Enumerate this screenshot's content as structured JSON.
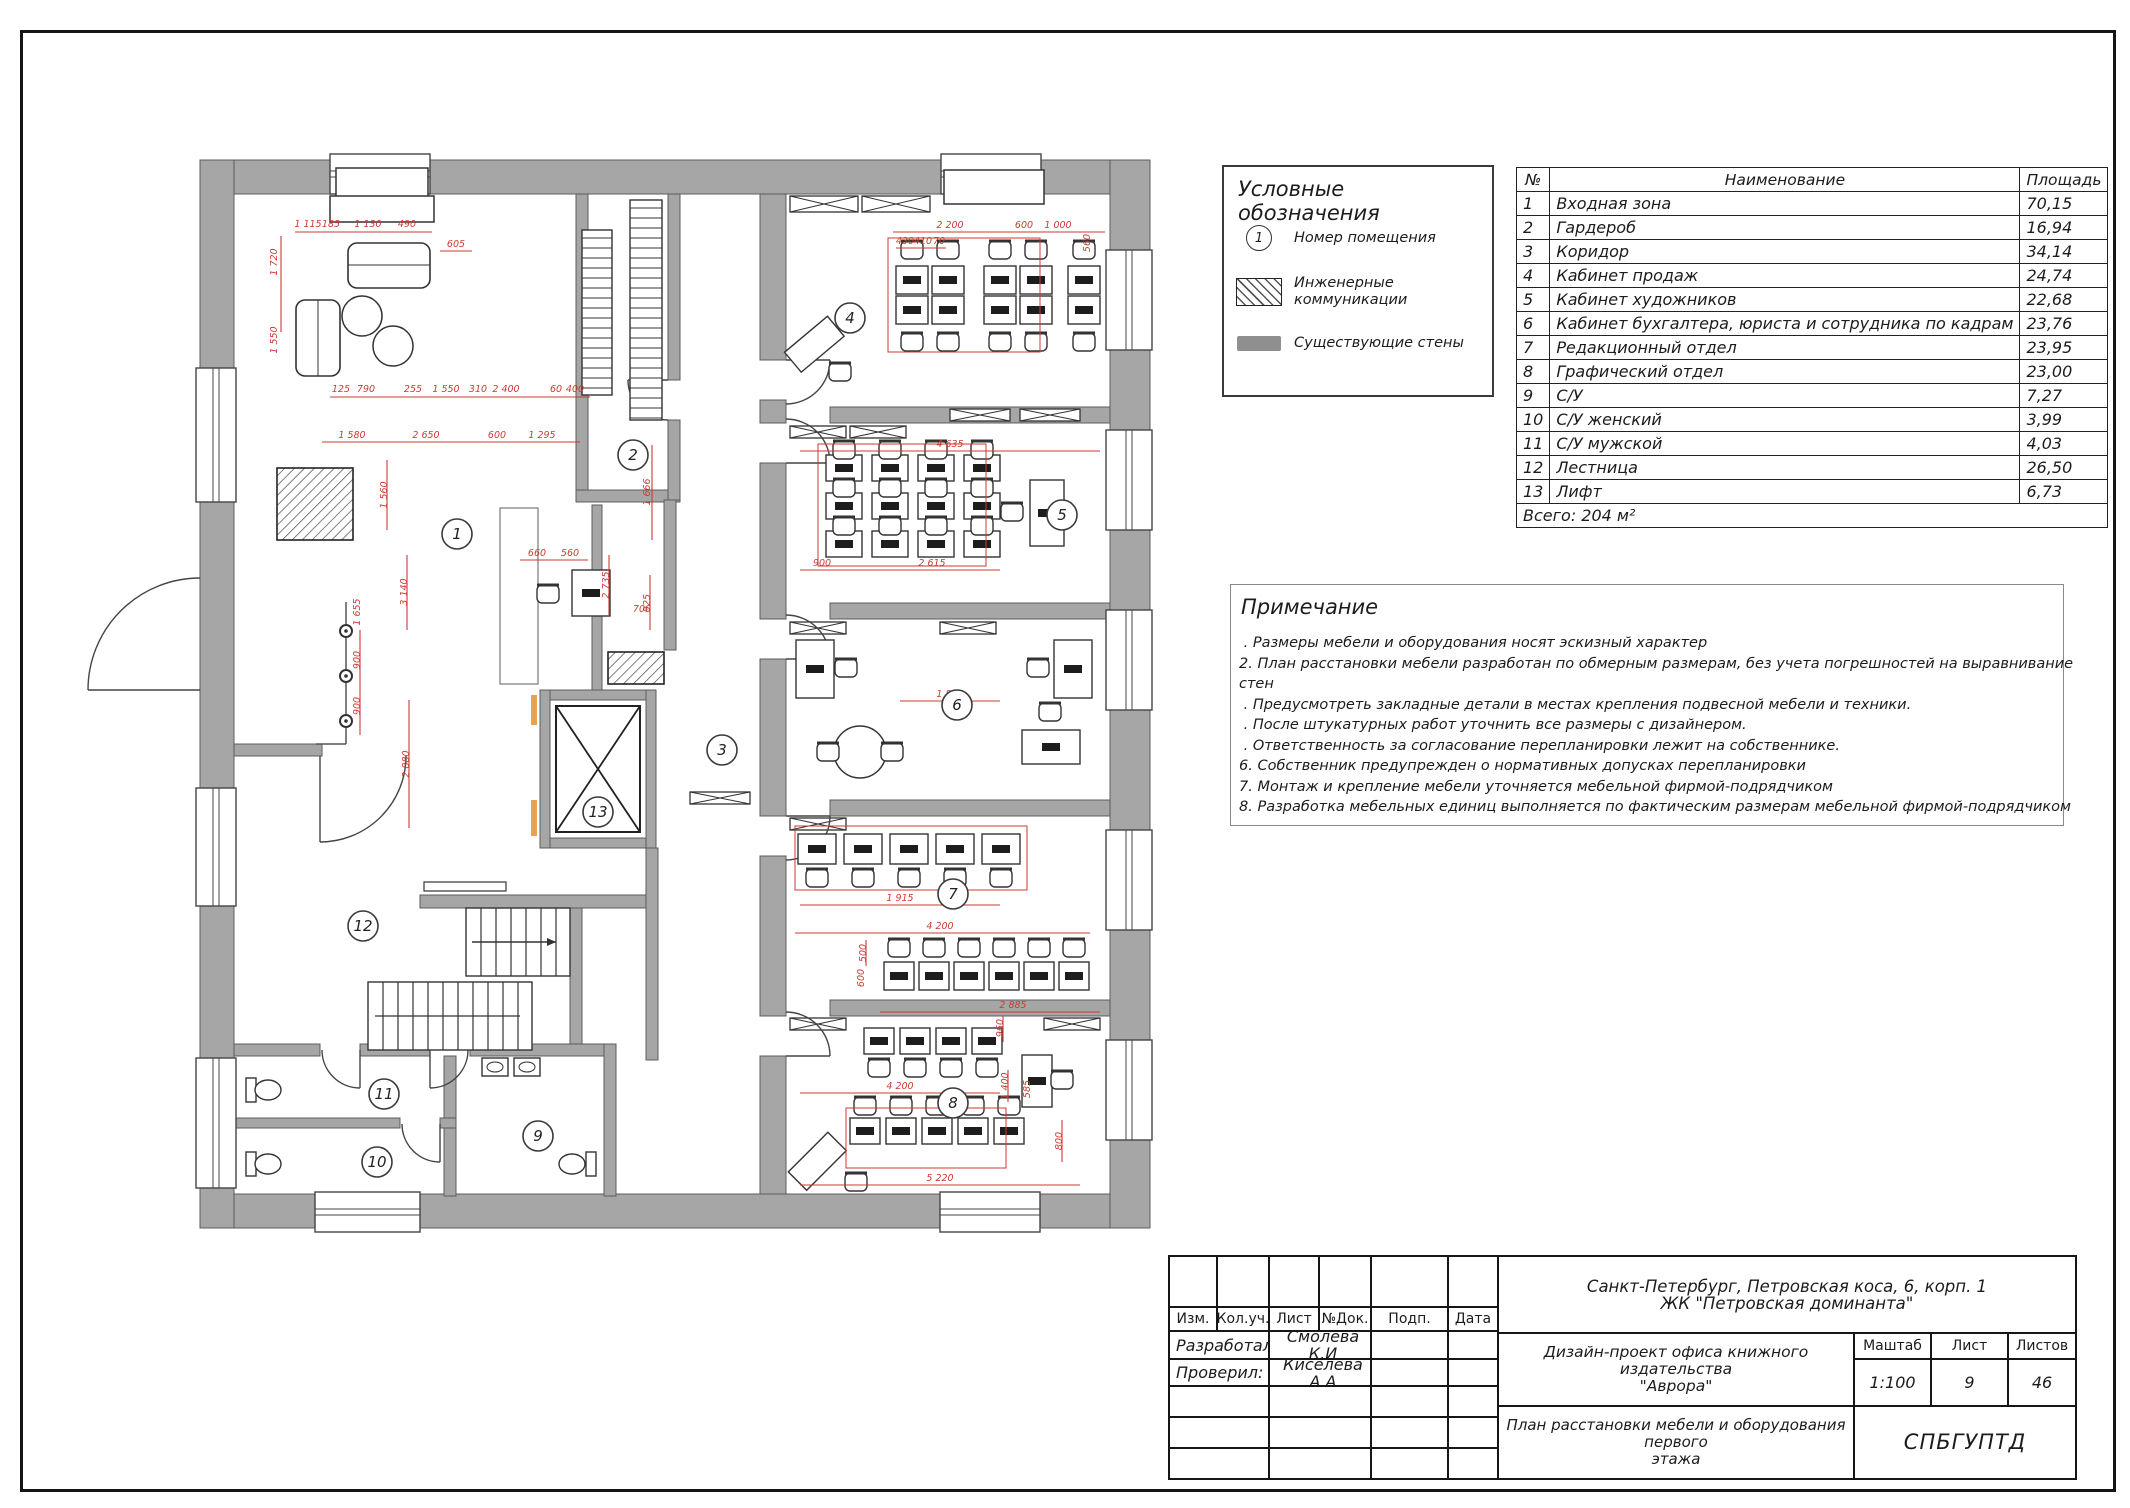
{
  "colors": {
    "wall_gray": "#a6a6a6",
    "dimension_red": "#cc3b33",
    "accent_orange": "#e8a255",
    "line_dark": "#2a2a2a"
  },
  "legend": {
    "title": "Условные обозначения",
    "items": [
      {
        "symbol": "room-number-icon",
        "symbol_text": "1",
        "label": "Номер помещения",
        "label2": ""
      },
      {
        "symbol": "hatch-icon",
        "symbol_text": "",
        "label": "Инженерные",
        "label2": "коммуникации"
      },
      {
        "symbol": "wall-icon",
        "symbol_text": "",
        "label": "Существующие стены",
        "label2": ""
      }
    ]
  },
  "rooms_table": {
    "headers": [
      "№",
      "Наименование",
      "Площадь"
    ],
    "rows": [
      [
        "1",
        "Входная зона",
        "70,15"
      ],
      [
        "2",
        "Гардероб",
        "16,94"
      ],
      [
        "3",
        "Коридор",
        "34,14"
      ],
      [
        "4",
        "Кабинет продаж",
        "24,74"
      ],
      [
        "5",
        "Кабинет художников",
        "22,68"
      ],
      [
        "6",
        "Кабинет бухгалтера, юриста и сотрудника  по кадрам",
        "23,76"
      ],
      [
        "7",
        "Редакционный отдел",
        "23,95"
      ],
      [
        "8",
        "Графический отдел",
        "23,00"
      ],
      [
        "9",
        "С/У",
        "7,27"
      ],
      [
        "10",
        "С/У женский",
        "3,99"
      ],
      [
        "11",
        "С/У мужской",
        "4,03"
      ],
      [
        "12",
        "Лестница",
        "26,50"
      ],
      [
        "13",
        "Лифт",
        "6,73"
      ]
    ],
    "total": "Всего: 204 м²"
  },
  "notes": {
    "title": "Примечание",
    "lines": [
      " . Размеры мебели и оборудования носят эскизный характер",
      "2. План расстановки мебели разработан по обмерным размерам, без учета погрешностей на выравнивание",
      "стен",
      " . Предусмотреть закладные детали в местах крепления подвесной мебели и техники.",
      " . После штукатурных работ уточнить все размеры с дизайнером.",
      " . Ответственность за согласование перепланировки лежит на собственнике.",
      "6. Собственник предупрежден о нормативных допусках перепланировки",
      "7. Монтаж и крепление мебели уточняется мебельной фирмой-подрядчиком",
      "8. Разработка мебельных единиц выполняется по фактическим размерам мебельной фирмой-подрядчиком"
    ]
  },
  "title_block": {
    "columns": [
      "Изм.",
      "Кол.уч.",
      "Лист",
      "№Док.",
      "Подп.",
      "Дата"
    ],
    "developed_label": "Разработал:",
    "developed_name": "Смолева К.И",
    "checked_label": "Проверил:",
    "checked_name": "Киселева А.А",
    "address_line1": "Санкт-Петербург, Петровская коса, 6, корп. 1",
    "address_line2": "ЖК \"Петровская доминанта\"",
    "project_line1": "Дизайн-проект офиса книжного издательства",
    "project_line2": "\"Аврора\"",
    "scale_label": "Маштаб",
    "scale_value": "1:100",
    "sheet_label": "Лист",
    "sheet_value": "9",
    "sheets_label": "Листов",
    "sheets_value": "46",
    "drawing_title_line1": "План расстановки мебели и оборудования первого",
    "drawing_title_line2": "этажа",
    "organization": "СПБГУПТД"
  },
  "floor_plan": {
    "room_labels": [
      {
        "n": "1",
        "x": 457,
        "y": 534
      },
      {
        "n": "2",
        "x": 633,
        "y": 455
      },
      {
        "n": "3",
        "x": 722,
        "y": 750
      },
      {
        "n": "4",
        "x": 850,
        "y": 318
      },
      {
        "n": "5",
        "x": 1062,
        "y": 515
      },
      {
        "n": "6",
        "x": 957,
        "y": 705
      },
      {
        "n": "7",
        "x": 953,
        "y": 894
      },
      {
        "n": "8",
        "x": 953,
        "y": 1103
      },
      {
        "n": "9",
        "x": 538,
        "y": 1136
      },
      {
        "n": "10",
        "x": 377,
        "y": 1162
      },
      {
        "n": "11",
        "x": 384,
        "y": 1094
      },
      {
        "n": "12",
        "x": 363,
        "y": 926
      },
      {
        "n": "13",
        "x": 598,
        "y": 812
      }
    ],
    "dim_labels": [
      {
        "t": "1 115",
        "x": 308,
        "y": 227
      },
      {
        "t": "185",
        "x": 331,
        "y": 227
      },
      {
        "t": "1 130",
        "x": 368,
        "y": 227
      },
      {
        "t": "490",
        "x": 407,
        "y": 227
      },
      {
        "t": "605",
        "x": 456,
        "y": 247
      },
      {
        "t": "1 720",
        "x": 277,
        "y": 262,
        "v": 1
      },
      {
        "t": "1 550",
        "x": 277,
        "y": 340,
        "v": 1
      },
      {
        "t": "125",
        "x": 341,
        "y": 392
      },
      {
        "t": "790",
        "x": 366,
        "y": 392
      },
      {
        "t": "255",
        "x": 413,
        "y": 392
      },
      {
        "t": "1 550",
        "x": 446,
        "y": 392
      },
      {
        "t": "310",
        "x": 478,
        "y": 392
      },
      {
        "t": "2 400",
        "x": 506,
        "y": 392
      },
      {
        "t": "60",
        "x": 556,
        "y": 392
      },
      {
        "t": "400",
        "x": 575,
        "y": 392
      },
      {
        "t": "1 580",
        "x": 352,
        "y": 438
      },
      {
        "t": "2 650",
        "x": 426,
        "y": 438
      },
      {
        "t": "600",
        "x": 497,
        "y": 438
      },
      {
        "t": "1 295",
        "x": 542,
        "y": 438
      },
      {
        "t": "1 560",
        "x": 387,
        "y": 495,
        "v": 1
      },
      {
        "t": "3 140",
        "x": 407,
        "y": 592,
        "v": 1
      },
      {
        "t": "1 655",
        "x": 360,
        "y": 612,
        "v": 1
      },
      {
        "t": "900",
        "x": 360,
        "y": 660,
        "v": 1
      },
      {
        "t": "900",
        "x": 360,
        "y": 706,
        "v": 1
      },
      {
        "t": "2 880",
        "x": 409,
        "y": 764,
        "v": 1
      },
      {
        "t": "660",
        "x": 537,
        "y": 556
      },
      {
        "t": "560",
        "x": 570,
        "y": 556
      },
      {
        "t": "2 735",
        "x": 609,
        "y": 585,
        "v": 1
      },
      {
        "t": "925",
        "x": 650,
        "y": 603,
        "v": 1
      },
      {
        "t": "700",
        "x": 642,
        "y": 612
      },
      {
        "t": "1 666",
        "x": 650,
        "y": 492,
        "v": 1
      },
      {
        "t": "430",
        "x": 905,
        "y": 244
      },
      {
        "t": "410",
        "x": 923,
        "y": 244
      },
      {
        "t": "70",
        "x": 939,
        "y": 244
      },
      {
        "t": "2 200",
        "x": 950,
        "y": 228
      },
      {
        "t": "600",
        "x": 1024,
        "y": 228
      },
      {
        "t": "1 000",
        "x": 1058,
        "y": 228
      },
      {
        "t": "560",
        "x": 1090,
        "y": 243,
        "v": 1
      },
      {
        "t": "4 635",
        "x": 950,
        "y": 447
      },
      {
        "t": "900",
        "x": 822,
        "y": 566
      },
      {
        "t": "2 615",
        "x": 932,
        "y": 566
      },
      {
        "t": "1 865",
        "x": 950,
        "y": 697
      },
      {
        "t": "1 915",
        "x": 900,
        "y": 901
      },
      {
        "t": "4 200",
        "x": 940,
        "y": 929
      },
      {
        "t": "500",
        "x": 866,
        "y": 953,
        "v": 1
      },
      {
        "t": "600",
        "x": 864,
        "y": 978,
        "v": 1
      },
      {
        "t": "2 885",
        "x": 1013,
        "y": 1008
      },
      {
        "t": "960",
        "x": 1003,
        "y": 1028,
        "v": 1
      },
      {
        "t": "4 200",
        "x": 900,
        "y": 1089
      },
      {
        "t": "1 400",
        "x": 1008,
        "y": 1086,
        "v": 1
      },
      {
        "t": "585",
        "x": 1030,
        "y": 1089,
        "v": 1
      },
      {
        "t": "5 220",
        "x": 940,
        "y": 1181
      },
      {
        "t": "800",
        "x": 1062,
        "y": 1141,
        "v": 1
      }
    ]
  }
}
